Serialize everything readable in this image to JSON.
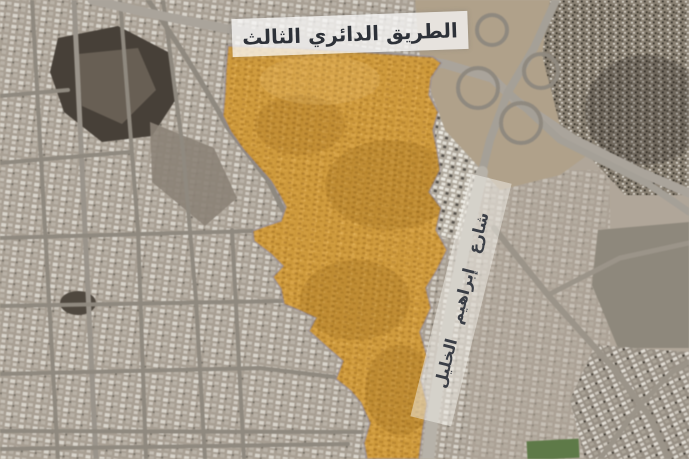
{
  "map": {
    "banner": {
      "text": "الطريق الدائري الثالث",
      "text_color": "#2d3138",
      "bg_color": "rgba(250,250,249,0.75)"
    },
    "street_label": {
      "text": "شارع إبراهيم الخليل",
      "text_color": "#3a3e46"
    },
    "highlight": {
      "fill": "#d9971f",
      "opacity": "0.8",
      "border": "#8d86a0"
    }
  }
}
